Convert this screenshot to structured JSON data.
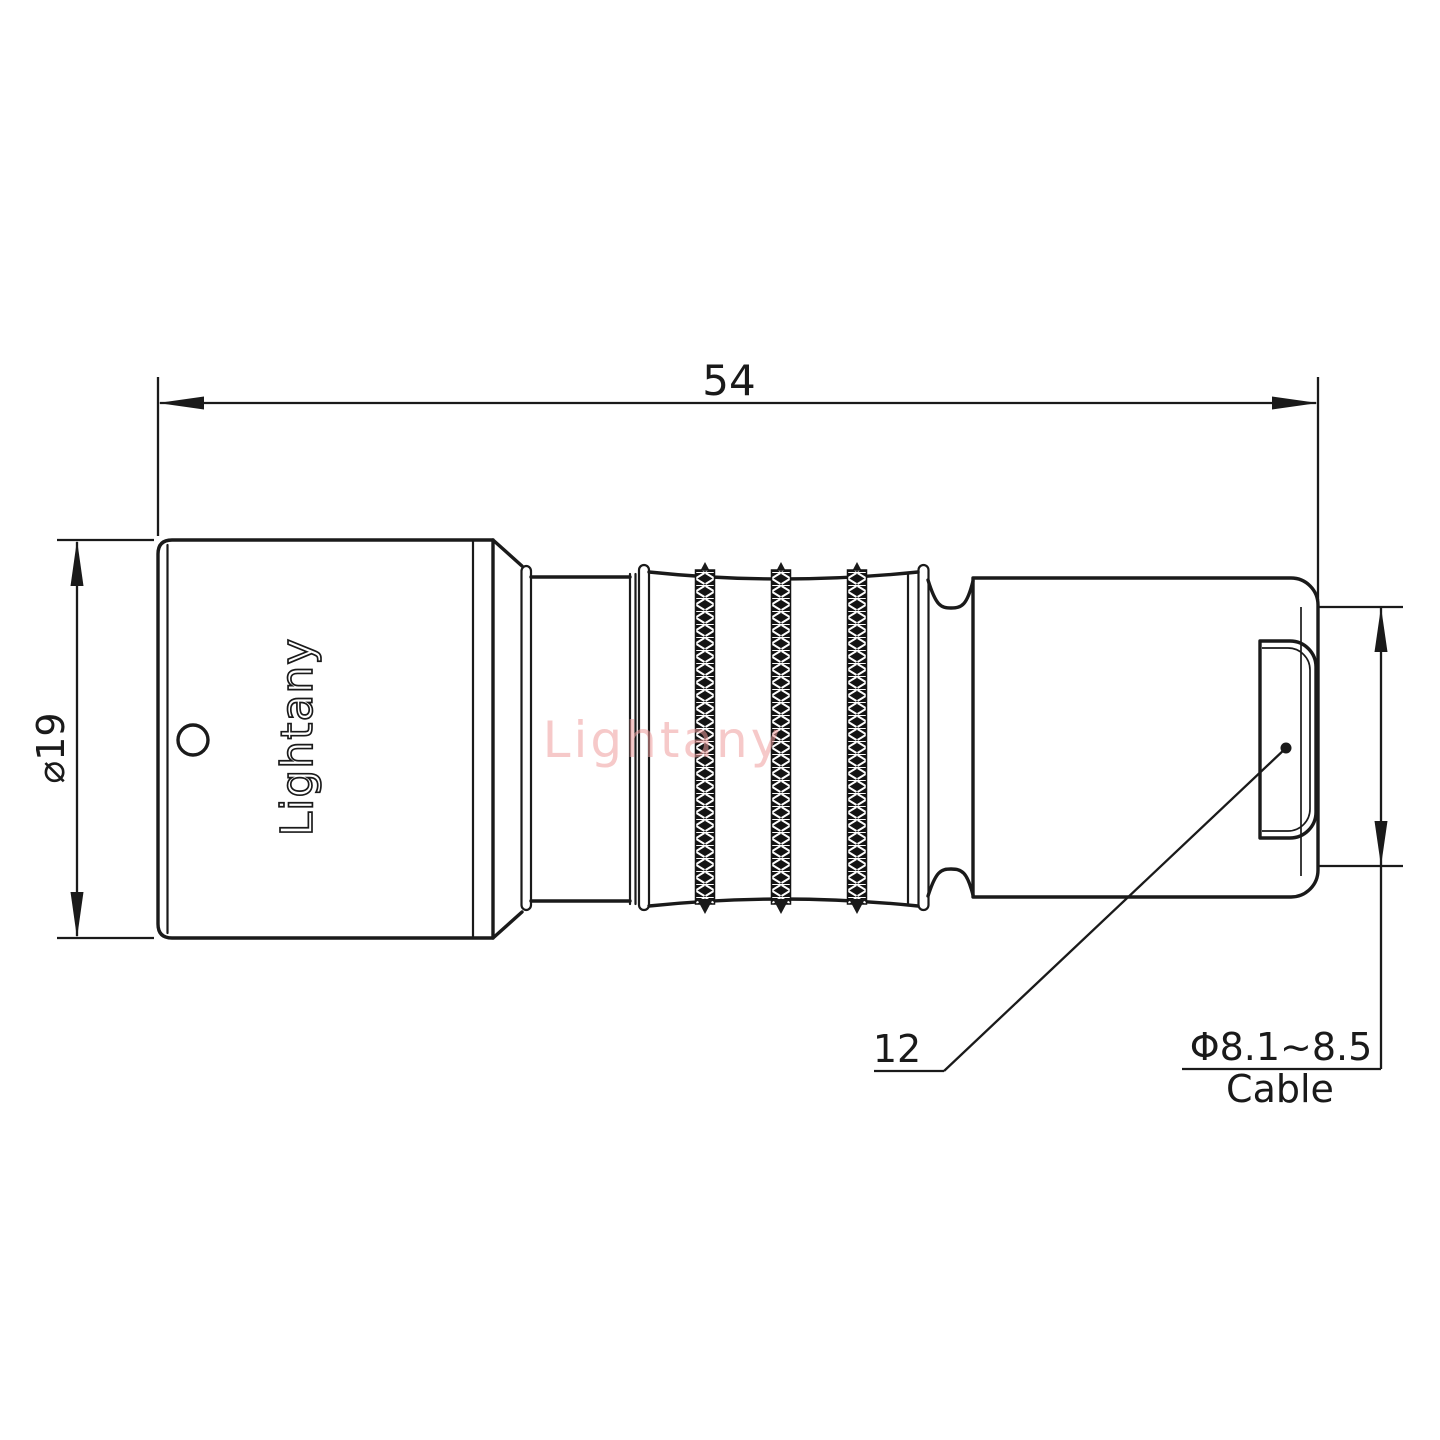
{
  "drawing": {
    "brand_logo": "Lightany",
    "watermark": "Lightany",
    "dims": {
      "overall_length": "54",
      "body_diameter": "⌀19",
      "rear_face": "12",
      "cable_diameter": "Φ8.1~8.5",
      "cable_label": "Cable"
    },
    "colors": {
      "line": "#1a1a1a",
      "watermark": "#ef9e9e",
      "background": "#ffffff"
    }
  }
}
